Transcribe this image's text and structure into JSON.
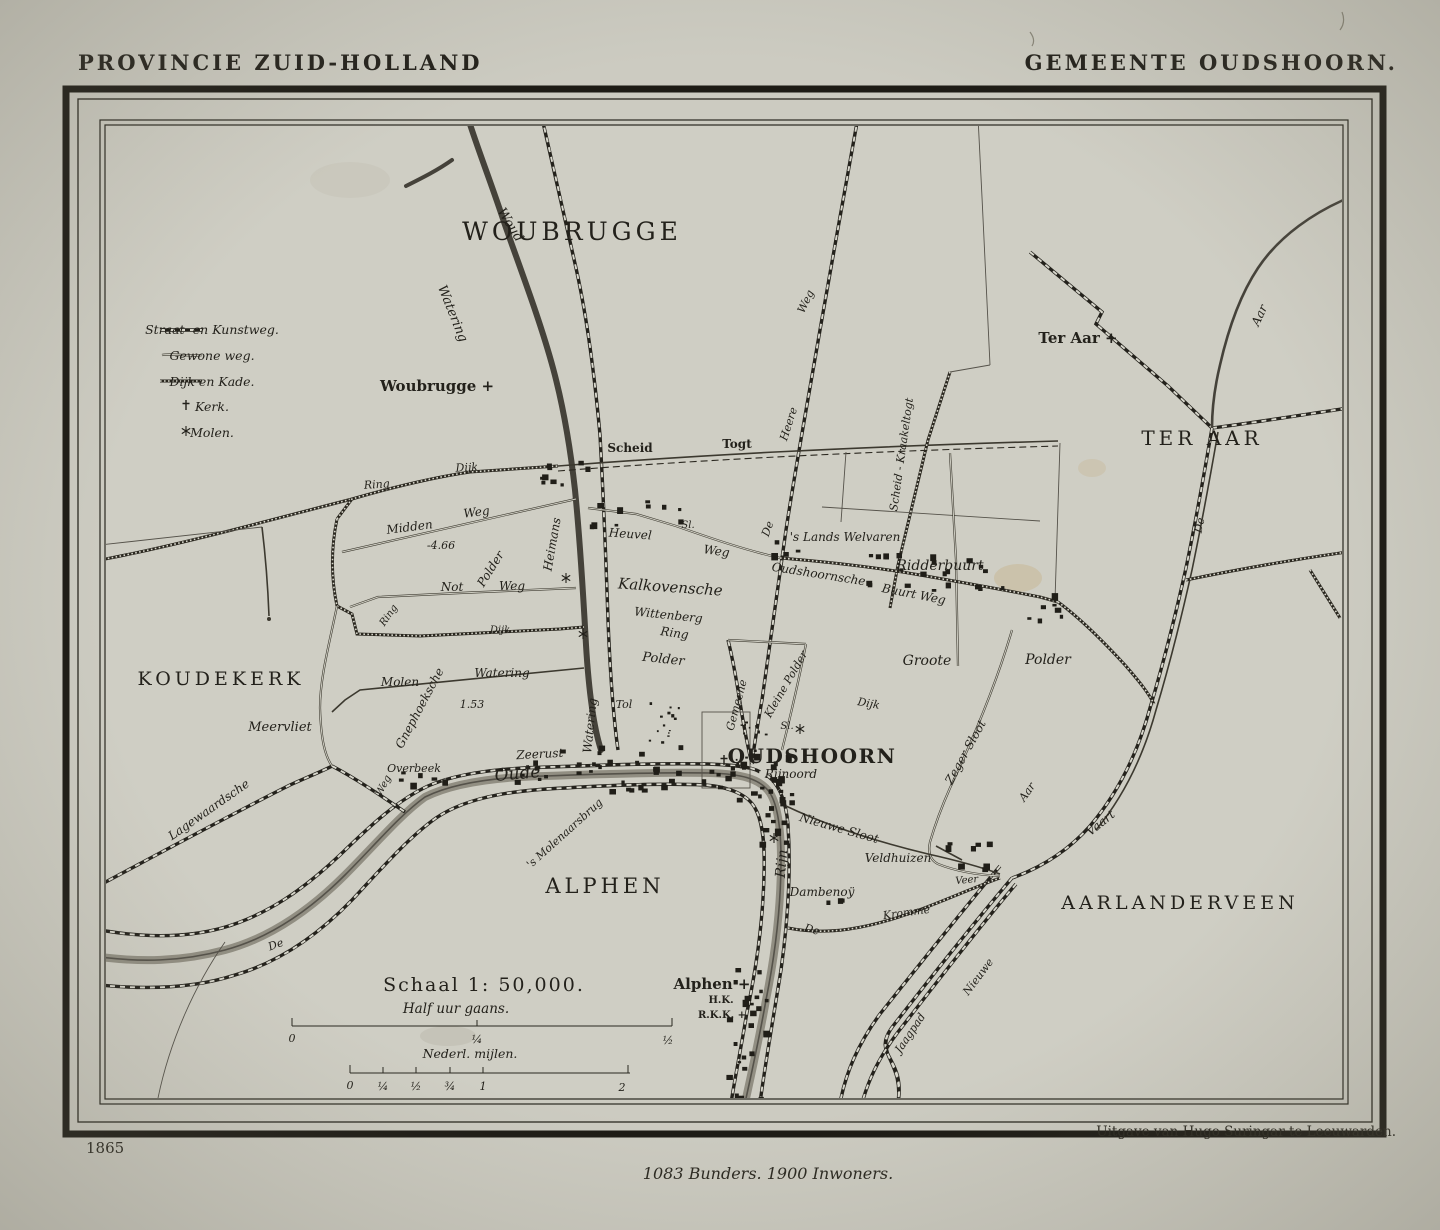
{
  "page": {
    "title_left": "PROVINCIE ZUID-HOLLAND",
    "title_right": "GEMEENTE OUDSHOORN.",
    "year": "1865",
    "publisher": "Uitgave van Hugo Suringar te Leeuwarden.",
    "statistics": "1083 Bunders. 1900 Inwoners."
  },
  "legend": {
    "items": [
      {
        "symbol": "straat-kunstweg-line",
        "label": "Straat- en Kunstweg."
      },
      {
        "symbol": "gewone-weg-line",
        "label": "Gewone weg."
      },
      {
        "symbol": "dijk-kade-line",
        "label": "Dijk en Kade."
      },
      {
        "symbol": "kerk-cross",
        "label": "Kerk."
      },
      {
        "symbol": "molen-star",
        "label": "Molen."
      }
    ]
  },
  "scale": {
    "title": "Schaal 1: 50,000.",
    "bar1_label": "Half uur gaans.",
    "bar1_ticks": [
      "0",
      "¼",
      "½"
    ],
    "bar2_label": "Nederl. mijlen.",
    "bar2_ticks": [
      "0",
      "¼",
      "½",
      "¾",
      "1",
      "2"
    ]
  },
  "colors": {
    "paper": "#cccbc1",
    "map_paper": "#cfcec4",
    "ink": "#23211b",
    "stain": "#c2a56c"
  },
  "map": {
    "labels": [
      {
        "t": "WOUBRUGGE",
        "x": 572,
        "y": 240,
        "s": 25,
        "ls": 50,
        "cls": "region"
      },
      {
        "t": "TER AAR",
        "x": 1202,
        "y": 445,
        "s": 20,
        "ls": 8,
        "cls": "region"
      },
      {
        "t": "KOUDEKERK",
        "x": 221,
        "y": 685,
        "s": 19,
        "ls": 4,
        "cls": "region"
      },
      {
        "t": "ALPHEN",
        "x": 605,
        "y": 893,
        "s": 21,
        "ls": 6,
        "cls": "region"
      },
      {
        "t": "AARLANDERVEEN",
        "x": 1180,
        "y": 909,
        "s": 19,
        "ls": 4,
        "cls": "region"
      },
      {
        "t": "OUDSHOORN",
        "x": 812,
        "y": 763,
        "s": 20,
        "ls": 1.5,
        "cls": "town"
      },
      {
        "t": "Woubrugge +",
        "x": 437,
        "y": 391,
        "s": 15,
        "cls": "village"
      },
      {
        "t": "Ter Aar +",
        "x": 1078,
        "y": 343,
        "s": 15,
        "cls": "village"
      },
      {
        "t": "Alphen +",
        "x": 712,
        "y": 989,
        "s": 15,
        "cls": "village"
      },
      {
        "t": "H.K.",
        "x": 721,
        "y": 1003,
        "s": 10,
        "cls": "village"
      },
      {
        "t": "R.K.K. +",
        "x": 722,
        "y": 1018,
        "s": 10,
        "cls": "village"
      },
      {
        "t": "Scheid",
        "x": 630,
        "y": 452,
        "s": 12,
        "cls": "road"
      },
      {
        "t": "Togt",
        "x": 737,
        "y": 448,
        "s": 12,
        "cls": "road"
      },
      {
        "t": "'s Lands Welvaren",
        "x": 845,
        "y": 541,
        "s": 12,
        "cls": "ham"
      },
      {
        "t": "Ridderbuurt",
        "x": 940,
        "y": 570,
        "s": 14,
        "cls": "ham"
      },
      {
        "t": "Oudshoornsche",
        "x": 818,
        "y": 578,
        "s": 12,
        "r": 9
      },
      {
        "t": "Buurt Weg",
        "x": 913,
        "y": 598,
        "s": 12,
        "r": 11
      },
      {
        "t": "Woud",
        "x": 507,
        "y": 227,
        "s": 13,
        "r": 58
      },
      {
        "t": "Watering",
        "x": 449,
        "y": 315,
        "s": 13,
        "r": 68
      },
      {
        "t": "Heimans",
        "x": 556,
        "y": 545,
        "s": 12,
        "r": -80
      },
      {
        "t": "Watering",
        "x": 594,
        "y": 726,
        "s": 12,
        "r": -84
      },
      {
        "t": "Weg",
        "x": 809,
        "y": 303,
        "s": 11,
        "r": -65
      },
      {
        "t": "Heere",
        "x": 792,
        "y": 425,
        "s": 11,
        "r": -72
      },
      {
        "t": "De",
        "x": 771,
        "y": 530,
        "s": 11,
        "r": -70
      },
      {
        "t": "Scheid - Kraakeltogt",
        "x": 905,
        "y": 455,
        "s": 11,
        "r": -82
      },
      {
        "t": "Heuvel",
        "x": 630,
        "y": 538,
        "s": 12,
        "r": 4
      },
      {
        "t": "Weg",
        "x": 716,
        "y": 555,
        "s": 12,
        "r": 8
      },
      {
        "t": "Sl.",
        "x": 688,
        "y": 528,
        "s": 10
      },
      {
        "t": "Kalkovensche",
        "x": 670,
        "y": 592,
        "s": 15,
        "r": 4
      },
      {
        "t": "Wittenberg",
        "x": 668,
        "y": 619,
        "s": 12,
        "r": 6
      },
      {
        "t": "Ring",
        "x": 674,
        "y": 637,
        "s": 12,
        "r": 8
      },
      {
        "t": "Polder",
        "x": 663,
        "y": 663,
        "s": 13,
        "r": 6
      },
      {
        "t": "Groote",
        "x": 927,
        "y": 665,
        "s": 14
      },
      {
        "t": "Polder",
        "x": 1048,
        "y": 664,
        "s": 14
      },
      {
        "t": "Dijk",
        "x": 868,
        "y": 707,
        "s": 11,
        "r": 10
      },
      {
        "t": "Ring",
        "x": 377,
        "y": 488,
        "s": 11,
        "r": -4
      },
      {
        "t": "Dijk",
        "x": 467,
        "y": 471,
        "s": 11,
        "r": -3
      },
      {
        "t": "Midden",
        "x": 410,
        "y": 531,
        "s": 12,
        "r": -7
      },
      {
        "t": "Weg",
        "x": 477,
        "y": 516,
        "s": 12,
        "r": -7
      },
      {
        "t": "-4.66",
        "x": 441,
        "y": 549,
        "s": 11
      },
      {
        "t": "Polder",
        "x": 494,
        "y": 571,
        "s": 12,
        "r": -58
      },
      {
        "t": "Not",
        "x": 452,
        "y": 591,
        "s": 12
      },
      {
        "t": "Weg",
        "x": 512,
        "y": 590,
        "s": 12
      },
      {
        "t": "Ring",
        "x": 391,
        "y": 617,
        "s": 10,
        "r": -55
      },
      {
        "t": "Dijk",
        "x": 500,
        "y": 633,
        "s": 10
      },
      {
        "t": "Molen",
        "x": 400,
        "y": 686,
        "s": 12
      },
      {
        "t": "Watering",
        "x": 502,
        "y": 677,
        "s": 12
      },
      {
        "t": "Gnephoeksche",
        "x": 423,
        "y": 710,
        "s": 12,
        "r": -62
      },
      {
        "t": "1.53",
        "x": 472,
        "y": 708,
        "s": 11
      },
      {
        "t": "Meervliet",
        "x": 280,
        "y": 731,
        "s": 13
      },
      {
        "t": "Overbeek",
        "x": 414,
        "y": 772,
        "s": 11
      },
      {
        "t": "Weg",
        "x": 386,
        "y": 787,
        "s": 10,
        "r": -62
      },
      {
        "t": "Lagewaardsche",
        "x": 211,
        "y": 813,
        "s": 12,
        "r": -35
      },
      {
        "t": "Zeerust",
        "x": 540,
        "y": 758,
        "s": 12,
        "r": -3
      },
      {
        "t": "Oude",
        "x": 518,
        "y": 779,
        "s": 17,
        "r": -5
      },
      {
        "t": "Tol",
        "x": 624,
        "y": 708,
        "s": 11
      },
      {
        "t": "Gemeene",
        "x": 740,
        "y": 706,
        "s": 11,
        "r": -75
      },
      {
        "t": "Kleine Polder",
        "x": 789,
        "y": 686,
        "s": 11,
        "r": -60
      },
      {
        "t": "Sl.",
        "x": 787,
        "y": 729,
        "s": 10
      },
      {
        "t": "Rijnoord",
        "x": 791,
        "y": 778,
        "s": 12
      },
      {
        "t": "Rijn",
        "x": 786,
        "y": 864,
        "s": 14,
        "r": -85
      },
      {
        "t": "Nieuwe Sloot",
        "x": 838,
        "y": 832,
        "s": 12,
        "r": 16
      },
      {
        "t": "Veldhuizen",
        "x": 898,
        "y": 862,
        "s": 12
      },
      {
        "t": "Veer",
        "x": 967,
        "y": 883,
        "s": 10,
        "r": -5
      },
      {
        "t": "Dambenoÿ",
        "x": 822,
        "y": 896,
        "s": 12
      },
      {
        "t": "De",
        "x": 811,
        "y": 933,
        "s": 11,
        "r": 15
      },
      {
        "t": "Kromme",
        "x": 907,
        "y": 916,
        "s": 11,
        "r": -8
      },
      {
        "t": "Zeger Sloot",
        "x": 969,
        "y": 754,
        "s": 12,
        "r": -61
      },
      {
        "t": "Aar",
        "x": 1030,
        "y": 794,
        "s": 11,
        "r": -55
      },
      {
        "t": "Vaart",
        "x": 1103,
        "y": 826,
        "s": 12,
        "r": -39
      },
      {
        "t": "Nieuwe",
        "x": 981,
        "y": 979,
        "s": 11,
        "r": -53
      },
      {
        "t": "Jaagpad",
        "x": 913,
        "y": 1035,
        "s": 11,
        "r": -56
      },
      {
        "t": "'s Molenaarsbrug",
        "x": 567,
        "y": 836,
        "s": 11,
        "r": -42
      },
      {
        "t": "De",
        "x": 1203,
        "y": 526,
        "s": 11,
        "r": -78
      },
      {
        "t": "Aar",
        "x": 1263,
        "y": 317,
        "s": 12,
        "r": -65
      },
      {
        "t": "De",
        "x": 277,
        "y": 948,
        "s": 11,
        "r": -20
      }
    ],
    "building_clusters": [
      {
        "x": 540,
        "y": 455,
        "w": 48,
        "h": 32,
        "n": 9
      },
      {
        "x": 585,
        "y": 500,
        "w": 98,
        "h": 26,
        "n": 10
      },
      {
        "x": 770,
        "y": 540,
        "w": 26,
        "h": 14,
        "n": 4
      },
      {
        "x": 855,
        "y": 550,
        "w": 150,
        "h": 42,
        "n": 22
      },
      {
        "x": 1025,
        "y": 585,
        "w": 38,
        "h": 34,
        "n": 7
      },
      {
        "x": 395,
        "y": 770,
        "w": 48,
        "h": 18,
        "n": 6
      },
      {
        "x": 498,
        "y": 760,
        "w": 52,
        "h": 20,
        "n": 7
      },
      {
        "x": 560,
        "y": 745,
        "w": 120,
        "h": 45,
        "n": 24
      },
      {
        "x": 690,
        "y": 752,
        "w": 100,
        "h": 52,
        "n": 26
      },
      {
        "x": 755,
        "y": 805,
        "w": 38,
        "h": 38,
        "n": 8
      },
      {
        "x": 925,
        "y": 840,
        "w": 62,
        "h": 30,
        "n": 8
      },
      {
        "x": 812,
        "y": 896,
        "w": 30,
        "h": 16,
        "n": 4
      },
      {
        "x": 726,
        "y": 935,
        "w": 40,
        "h": 165,
        "n": 24
      },
      {
        "x": 648,
        "y": 700,
        "w": 30,
        "h": 42,
        "n": 14,
        "tiny": true
      },
      {
        "x": 735,
        "y": 716,
        "w": 32,
        "h": 48,
        "n": 14,
        "tiny": true
      }
    ],
    "kerk_marks": [
      [
        724,
        760
      ]
    ],
    "molen_marks": [
      [
        566,
        578
      ],
      [
        583,
        634
      ],
      [
        800,
        729
      ],
      [
        774,
        838
      ]
    ]
  }
}
